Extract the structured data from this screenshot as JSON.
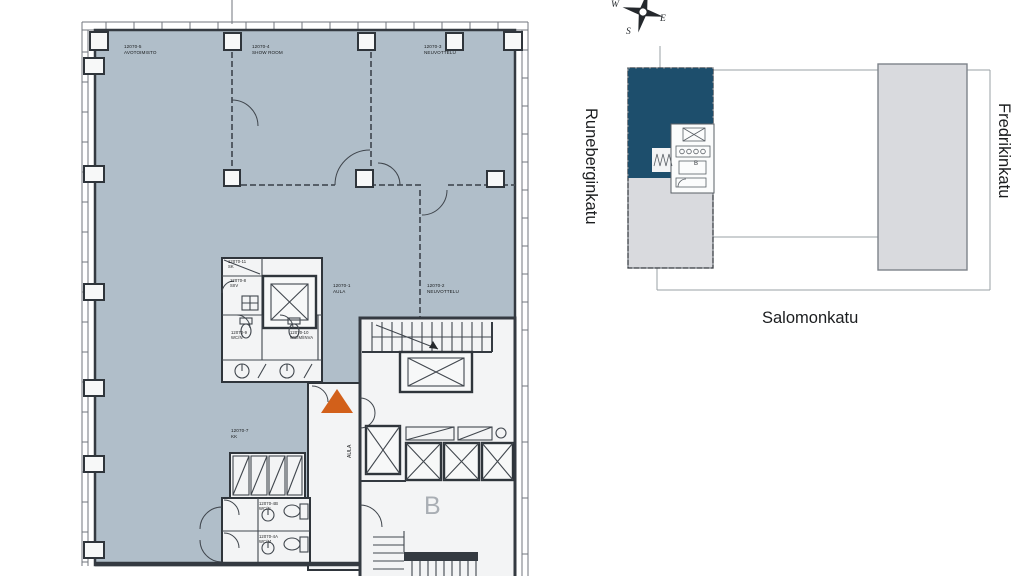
{
  "floorplan": {
    "rooms": [
      {
        "id": "12070-5",
        "name": "AVOTOIMISTO"
      },
      {
        "id": "12070-4",
        "name": "SHOW ROOM"
      },
      {
        "id": "12070-3",
        "name": "NEUVOTTELU"
      },
      {
        "id": "12070-2",
        "name": "NEUVOTTELU"
      },
      {
        "id": "12070-1",
        "name": "AULA"
      },
      {
        "id": "12070-11",
        "name": "SK"
      },
      {
        "id": "12070-8",
        "name": "SIIV"
      },
      {
        "id": "12070-9",
        "name": "WC/N"
      },
      {
        "id": "12070-10",
        "name": "WC/M/INVA"
      },
      {
        "id": "12070-7",
        "name": "KK"
      },
      {
        "id": "12070-4B",
        "name": "WC/N"
      },
      {
        "id": "12070-4A",
        "name": "WC/M"
      }
    ],
    "corridor_label": "AULA",
    "core_label": "B"
  },
  "keymap": {
    "streets": {
      "left": "Runeberginkatu",
      "right": "Fredrikinkatu",
      "bottom": "Salomonkatu"
    },
    "compass": {
      "west": "W",
      "east": "E",
      "south": "S"
    },
    "core_label": "B"
  },
  "colors": {
    "room_fill": "#b0bec9",
    "wall": "#343a41",
    "white_fill": "#f3f4f5",
    "facade_line": "#70767c",
    "partition": "#4a525a",
    "entrance_orange": "#d2601a",
    "keymap_dark": "#1d4e6c",
    "keymap_light": "#d9dade",
    "outline_gray": "#9aa0a6",
    "text_dark": "#17191b",
    "core_letter_gray": "#a9aeb4"
  }
}
